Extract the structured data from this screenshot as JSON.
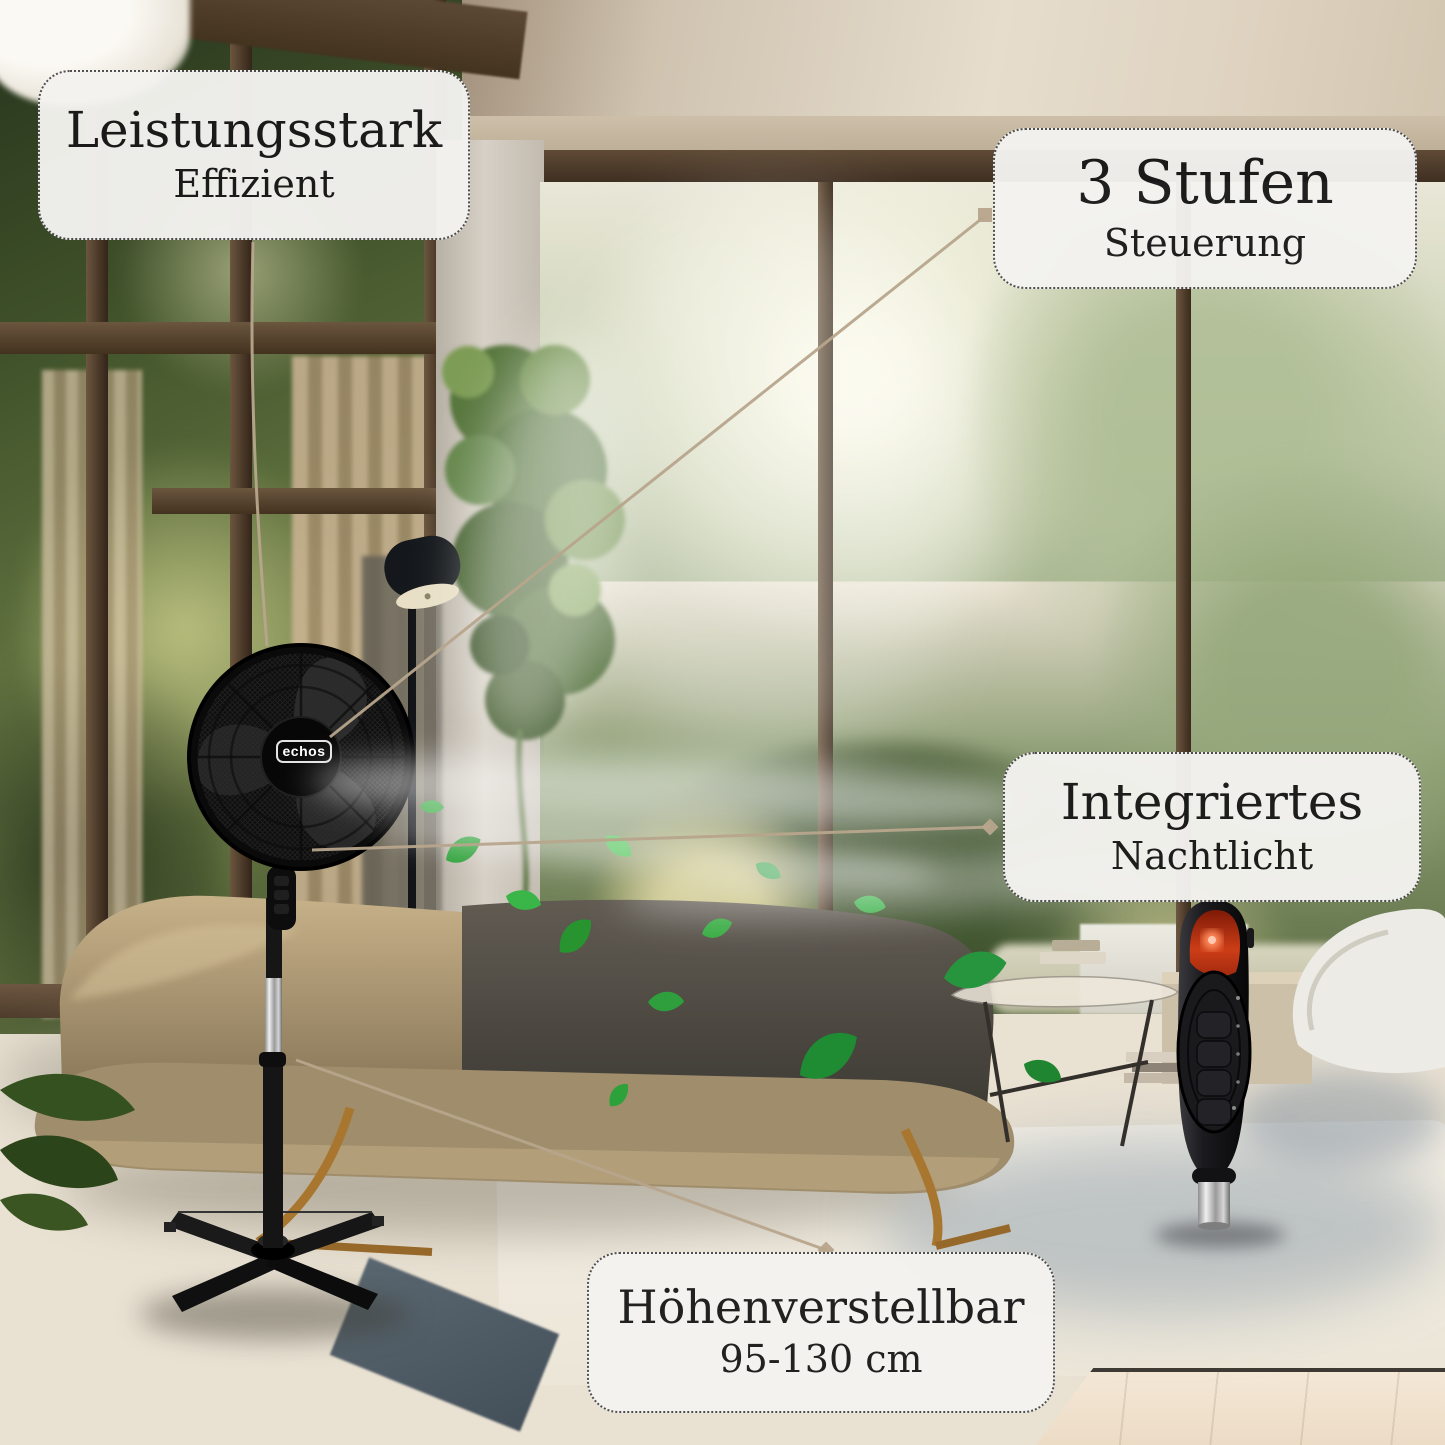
{
  "image_type": "product-feature-image",
  "brand": {
    "logo_text": "echos"
  },
  "feature_labels": {
    "power": {
      "title": "Leistungsstark",
      "subtitle": "Effizient"
    },
    "speed": {
      "title": "3 Stufen",
      "subtitle": "Steuerung"
    },
    "night_light": {
      "title": "Integriertes",
      "subtitle": "Nachtlicht"
    },
    "height": {
      "title": "Höhenverstellbar",
      "subtitle": "95-130 cm"
    }
  },
  "colors": {
    "label_background": "#f4f3f0",
    "label_border": "#4a4a4a",
    "label_text": "#191919",
    "callout_line": "#b7a58c",
    "night_light_glow": "#ff4a1e",
    "fan_body": "#141414",
    "chrome": "#c9c9c9"
  }
}
